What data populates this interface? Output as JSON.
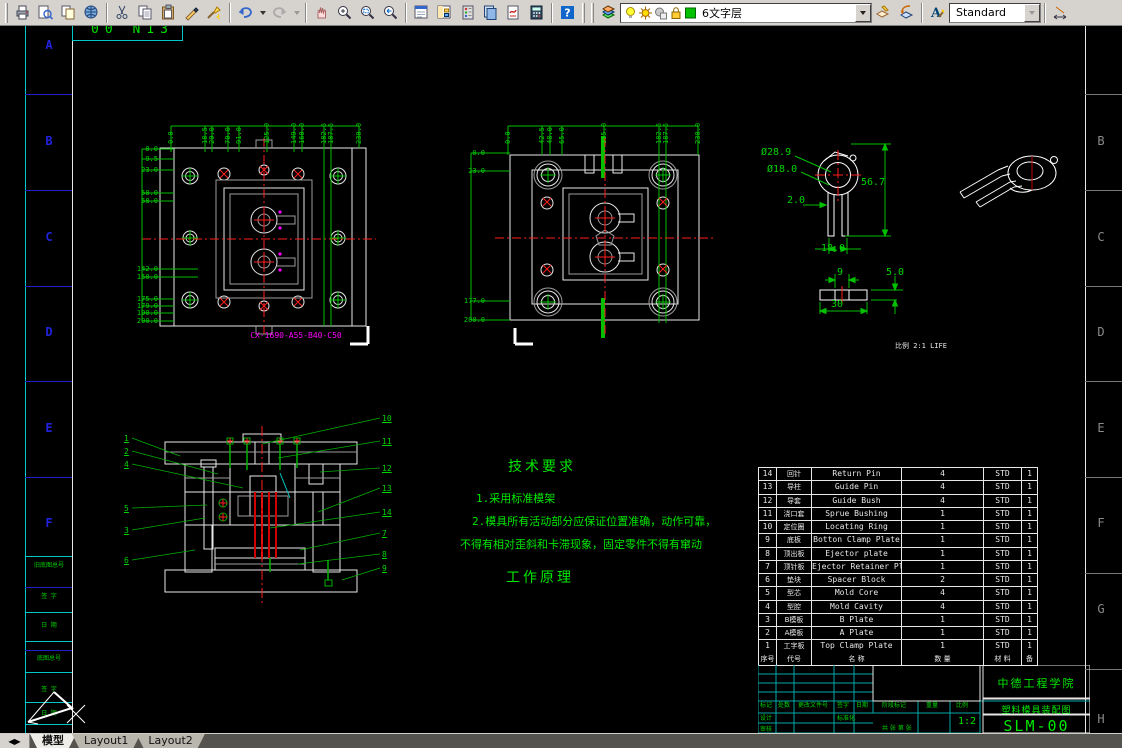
{
  "toolbar": {
    "layer_value": "6文字层",
    "style_value": "Standard",
    "icons": [
      "plot",
      "plot-preview",
      "publish",
      "etransmit",
      "cut",
      "copy",
      "paste",
      "match-properties",
      "property-painter",
      "undo",
      "redo",
      "pan-realtime",
      "zoom-realtime",
      "zoom-window",
      "zoom-previous",
      "properties",
      "designcenter",
      "tool-palettes",
      "sheetset-manager",
      "markup-set-manager",
      "quickcalc",
      "help",
      "layers",
      "bulb",
      "sun",
      "freeze",
      "lock",
      "color-swatch",
      "make-object-layer-current",
      "layer-previous",
      "text-style",
      "dim-style"
    ]
  },
  "sheet": {
    "corner_text": "00 N13",
    "zones_left": [
      {
        "t": "A",
        "y": 12
      },
      {
        "t": "B",
        "y": 108
      },
      {
        "t": "C",
        "y": 204
      },
      {
        "t": "D",
        "y": 299
      },
      {
        "t": "E",
        "y": 395
      },
      {
        "t": "F",
        "y": 490
      }
    ],
    "zones_right": [
      {
        "t": "B",
        "y": 108
      },
      {
        "t": "C",
        "y": 204
      },
      {
        "t": "D",
        "y": 299
      },
      {
        "t": "E",
        "y": 395
      },
      {
        "t": "F",
        "y": 490
      },
      {
        "t": "G",
        "y": 576
      },
      {
        "t": "H",
        "y": 686
      }
    ],
    "strip_labels": [
      {
        "t": "旧底图总号",
        "y": 536
      },
      {
        "t": "签 字",
        "y": 567
      },
      {
        "t": "日 期",
        "y": 596
      },
      {
        "t": "底图总号",
        "y": 629
      },
      {
        "t": "签 字",
        "y": 660
      },
      {
        "t": "日 期",
        "y": 684
      }
    ]
  },
  "plate_view1": {
    "code": "CX-1690-A55-B40-C50",
    "dims_left": [
      {
        "t": "0.0",
        "y": 34
      },
      {
        "t": "9.5",
        "y": 44
      },
      {
        "t": "23.0",
        "y": 55
      },
      {
        "t": "50.0",
        "y": 78
      },
      {
        "t": "58.0",
        "y": 86
      },
      {
        "t": "142.0",
        "y": 154
      },
      {
        "t": "150.0",
        "y": 162
      },
      {
        "t": "175.0",
        "y": 184
      },
      {
        "t": "179.0",
        "y": 191
      },
      {
        "t": "190.0",
        "y": 198
      },
      {
        "t": "200.0",
        "y": 206
      }
    ],
    "dims_top": [
      {
        "t": "0.0",
        "x": 40
      },
      {
        "t": "18.5",
        "x": 74
      },
      {
        "t": "20.0",
        "x": 81
      },
      {
        "t": "70.0",
        "x": 97
      },
      {
        "t": "91.0",
        "x": 108
      },
      {
        "t": "125.0",
        "x": 136
      },
      {
        "t": "149.0",
        "x": 163
      },
      {
        "t": "160.0",
        "x": 171
      },
      {
        "t": "182.5",
        "x": 193
      },
      {
        "t": "187.5",
        "x": 200
      },
      {
        "t": "230.0",
        "x": 228
      }
    ]
  },
  "plate_view2": {
    "dims_left": [
      {
        "t": "0.0",
        "y": 38
      },
      {
        "t": "23.0",
        "y": 56
      },
      {
        "t": "177.0",
        "y": 186
      },
      {
        "t": "200.0",
        "y": 205
      }
    ],
    "dims_top": [
      {
        "t": "0.0",
        "x": 50
      },
      {
        "t": "42.5",
        "x": 84
      },
      {
        "t": "48.0",
        "x": 92
      },
      {
        "t": "65.0",
        "x": 104
      },
      {
        "t": "115.0",
        "x": 146
      },
      {
        "t": "182.5",
        "x": 201
      },
      {
        "t": "187.5",
        "x": 208
      },
      {
        "t": "230.0",
        "x": 240
      }
    ]
  },
  "part_view": {
    "scale_note": "比例 2:1 LIFE",
    "dims": [
      {
        "t": "Ø28.9",
        "x": 16,
        "y": 18
      },
      {
        "t": "Ø18.0",
        "x": 22,
        "y": 35
      },
      {
        "t": "56.7",
        "x": 116,
        "y": 48
      },
      {
        "t": "2.0",
        "x": 42,
        "y": 66
      },
      {
        "t": "18.0",
        "x": 76,
        "y": 114
      },
      {
        "t": "9",
        "x": 92,
        "y": 138
      },
      {
        "t": "5.0",
        "x": 141,
        "y": 138
      },
      {
        "t": "30",
        "x": 86,
        "y": 170
      }
    ]
  },
  "section_view": {
    "balloons_left": [
      {
        "t": "1",
        "x": 14,
        "y": 34
      },
      {
        "t": "2",
        "x": 14,
        "y": 47
      },
      {
        "t": "4",
        "x": 14,
        "y": 60
      },
      {
        "t": "5",
        "x": 14,
        "y": 104
      },
      {
        "t": "3",
        "x": 14,
        "y": 126
      },
      {
        "t": "6",
        "x": 14,
        "y": 156
      }
    ],
    "balloons_right": [
      {
        "t": "10",
        "x": 272,
        "y": 14
      },
      {
        "t": "11",
        "x": 272,
        "y": 37
      },
      {
        "t": "12",
        "x": 272,
        "y": 64
      },
      {
        "t": "13",
        "x": 272,
        "y": 84
      },
      {
        "t": "14",
        "x": 272,
        "y": 108
      },
      {
        "t": "7",
        "x": 272,
        "y": 129
      },
      {
        "t": "8",
        "x": 272,
        "y": 150
      },
      {
        "t": "9",
        "x": 272,
        "y": 164
      }
    ]
  },
  "notes": {
    "title": "技术要求",
    "line1": "1.采用标准模架",
    "line2": "2.模具所有活动部分应保证位置准确，动作可靠，",
    "line3": "不得有相对歪斜和卡滞现象，固定零件不得有窜动",
    "subtitle": "工作原理"
  },
  "bom": {
    "headers": [
      "序号",
      "代号",
      "名  称",
      "数 量",
      "材 料",
      "备"
    ],
    "rows": [
      {
        "num": "14",
        "code": "回针",
        "name": "Return Pin",
        "qty": "4",
        "std": "STD",
        "cnt": "1"
      },
      {
        "num": "13",
        "code": "导柱",
        "name": "Guide Pin",
        "qty": "4",
        "std": "STD",
        "cnt": "1"
      },
      {
        "num": "12",
        "code": "导套",
        "name": "Guide Bush",
        "qty": "4",
        "std": "STD",
        "cnt": "1"
      },
      {
        "num": "11",
        "code": "浇口套",
        "name": "Sprue Bushing",
        "qty": "1",
        "std": "STD",
        "cnt": "1"
      },
      {
        "num": "10",
        "code": "定位圈",
        "name": "Locating Ring",
        "qty": "1",
        "std": "STD",
        "cnt": "1"
      },
      {
        "num": "9",
        "code": "底板",
        "name": "Botton Clamp Plate",
        "qty": "1",
        "std": "STD",
        "cnt": "1"
      },
      {
        "num": "8",
        "code": "顶出板",
        "name": "Ejector plate",
        "qty": "1",
        "std": "STD",
        "cnt": "1"
      },
      {
        "num": "7",
        "code": "顶针板",
        "name": "Ejector Retainer Plate",
        "qty": "1",
        "std": "STD",
        "cnt": "1"
      },
      {
        "num": "6",
        "code": "垫块",
        "name": "Spacer Block",
        "qty": "2",
        "std": "STD",
        "cnt": "1"
      },
      {
        "num": "5",
        "code": "型芯",
        "name": "Mold Core",
        "qty": "4",
        "std": "STD",
        "cnt": "1"
      },
      {
        "num": "4",
        "code": "型腔",
        "name": "Mold Cavity",
        "qty": "4",
        "std": "STD",
        "cnt": "1"
      },
      {
        "num": "3",
        "code": "B模板",
        "name": "B Plate",
        "qty": "1",
        "std": "STD",
        "cnt": "1"
      },
      {
        "num": "2",
        "code": "A模板",
        "name": "A Plate",
        "qty": "1",
        "std": "STD",
        "cnt": "1"
      },
      {
        "num": "1",
        "code": "工字板",
        "name": "Top Clamp Plate",
        "qty": "1",
        "std": "STD",
        "cnt": "1"
      }
    ]
  },
  "title_block": {
    "company": "中德工程学院",
    "drawing_title": "塑料模具装配图",
    "drawing_no": "SLM-00",
    "scale": "1:2",
    "small_labels": [
      {
        "t": "标记",
        "x": 2,
        "y": 37
      },
      {
        "t": "处数",
        "x": 20,
        "y": 37
      },
      {
        "t": "更改文件号",
        "x": 40,
        "y": 37
      },
      {
        "t": "签字",
        "x": 79,
        "y": 37
      },
      {
        "t": "日期",
        "x": 98,
        "y": 37
      },
      {
        "t": "设计",
        "x": 2,
        "y": 50
      },
      {
        "t": "审核",
        "x": 2,
        "y": 61
      },
      {
        "t": "标准化",
        "x": 79,
        "y": 50
      },
      {
        "t": "阶段标记",
        "x": 124,
        "y": 37
      },
      {
        "t": "重量",
        "x": 168,
        "y": 37
      },
      {
        "t": "比例",
        "x": 198,
        "y": 37
      },
      {
        "t": "共 张 第 张",
        "x": 124,
        "y": 60
      }
    ]
  },
  "tabs": {
    "items": [
      "模型",
      "Layout1",
      "Layout2"
    ]
  }
}
